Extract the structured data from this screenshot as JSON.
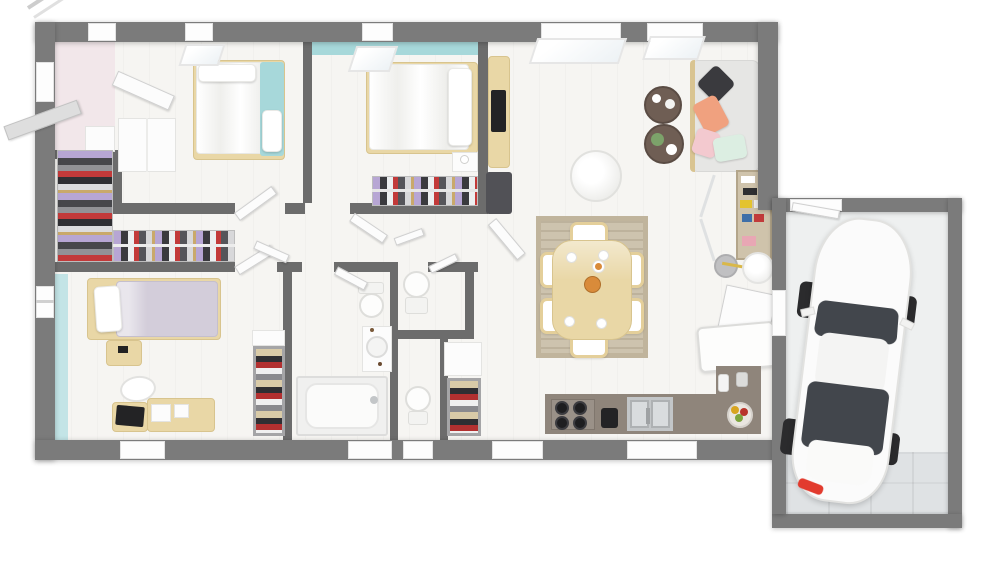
{
  "meta": {
    "title": "3D house floor plan, top-down render",
    "description": "Architectural 3D floor plan of a single-storey house with three bedrooms, dressing room, bathroom, two WCs, open living-dining-kitchen and attached garage with a white car. No text labels rendered."
  },
  "palette": {
    "background": "#ffffff",
    "exterior_wall": "#7b7b7b",
    "interior_wall": "#6c6c6c",
    "floor": "#f6f5f2",
    "accent_teal": "#a7d8da",
    "accent_teal_light": "#c3e4e6",
    "accent_pink": "#f2e7ea",
    "wood": "#e9d7a6",
    "wood_dark": "#d9c491",
    "rug": "#cdc3ae",
    "sofa": "#e6e6e4",
    "pillow_black": "#3a3a3e",
    "pillow_salmon": "#f0a17f",
    "pillow_pink": "#f3c9cf",
    "pillow_mint": "#dceee2",
    "lavender_bedding": "#d3cdda",
    "counter": "#8f857b",
    "steel": "#c3c6c8",
    "appliance_black": "#232325",
    "coffee_table": "#6f5e54",
    "plant_green": "#7ca26a",
    "fruit_orange": "#d98b3a",
    "car_body": "#fbfbfb",
    "car_glass": "#42464c",
    "car_tire": "#2b2b2d",
    "car_taillight": "#e23b2e",
    "garage_floor": "#eef0f0",
    "garage_tiles": "#dfe2e4"
  },
  "rooms": [
    {
      "id": "entry",
      "furniture": [
        "front-door-open",
        "shoe-cabinet"
      ]
    },
    {
      "id": "bedroom-1",
      "furniture": [
        "double-bed",
        "teal-runner",
        "wardrobe",
        "open-wardrobe-door"
      ]
    },
    {
      "id": "dressing",
      "furniture": [
        "hanging-rack-vertical",
        "hanging-rack-horizontal"
      ]
    },
    {
      "id": "bedroom-2",
      "furniture": [
        "double-bed",
        "nightstand",
        "closet-rail",
        "desk",
        "monitor"
      ]
    },
    {
      "id": "bedroom-3",
      "furniture": [
        "single-bed",
        "nightstand",
        "desk",
        "laptop",
        "typewriter",
        "chair",
        "clothes-shelf"
      ]
    },
    {
      "id": "hallway",
      "furniture": [
        "open-doors"
      ]
    },
    {
      "id": "bathroom",
      "furniture": [
        "bathtub",
        "wall-sink",
        "toilet"
      ]
    },
    {
      "id": "wc-1",
      "furniture": [
        "toilet"
      ]
    },
    {
      "id": "wc-2",
      "furniture": [
        "toilet",
        "clothes-shelf",
        "linen-cabinet"
      ]
    },
    {
      "id": "living-dining",
      "furniture": [
        "sofa",
        "throw-pillows",
        "coffee-tables",
        "round-armchair",
        "dining-table",
        "dining-chairs",
        "rug",
        "pantry-shelf",
        "paper-lantern",
        "side-stool",
        "chest-freezer",
        "open-garage-door"
      ]
    },
    {
      "id": "kitchen",
      "furniture": [
        "l-counter",
        "cooktop",
        "double-sink",
        "coffee-machine",
        "fruit-bowl",
        "bottles"
      ]
    },
    {
      "id": "garage",
      "furniture": [
        "white-car",
        "pedestrian-door"
      ]
    }
  ]
}
